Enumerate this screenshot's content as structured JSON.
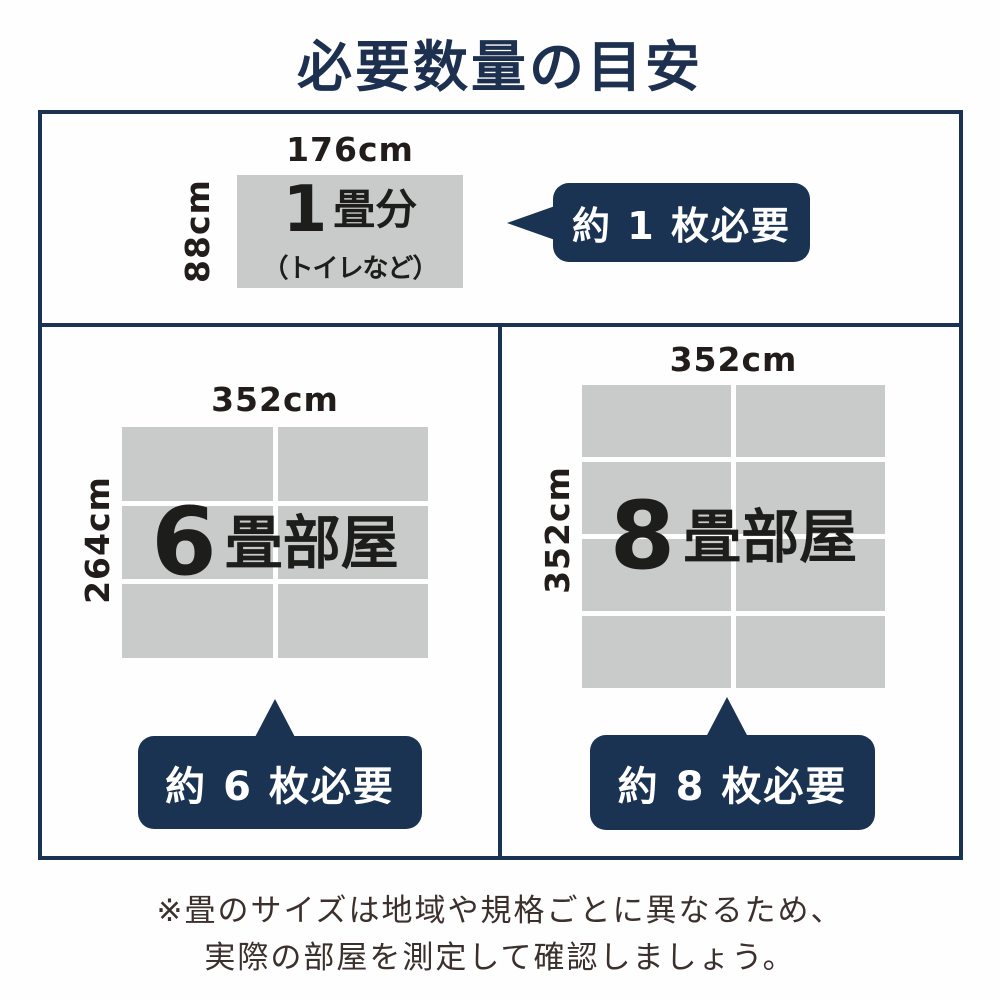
{
  "title": "必要数量の目安",
  "colors": {
    "navy": "#1a3352",
    "title_navy": "#1d3050",
    "cell_gray": "#c9caca",
    "dim_text": "#221d1a",
    "note_text": "#3b302c",
    "background": "#fefefe",
    "bubble_text": "#ffffff"
  },
  "sections": {
    "one": {
      "width_label": "176cm",
      "height_label": "88cm",
      "number": "1",
      "suffix": "畳分",
      "note": "（トイレなど）",
      "bubble_label": "約 1 枚必要"
    },
    "six": {
      "width_label": "352cm",
      "height_label": "264cm",
      "number": "6",
      "suffix": "畳部屋",
      "cell_count": 6,
      "bubble_label": "約 6 枚必要"
    },
    "eight": {
      "width_label": "352cm",
      "height_label": "352cm",
      "number": "8",
      "suffix": "畳部屋",
      "cell_count": 8,
      "bubble_label": "約 8 枚必要"
    }
  },
  "footnote": {
    "line1": "※畳のサイズは地域や規格ごとに異なるため、",
    "line2": "実際の部屋を測定して確認しましょう。"
  }
}
